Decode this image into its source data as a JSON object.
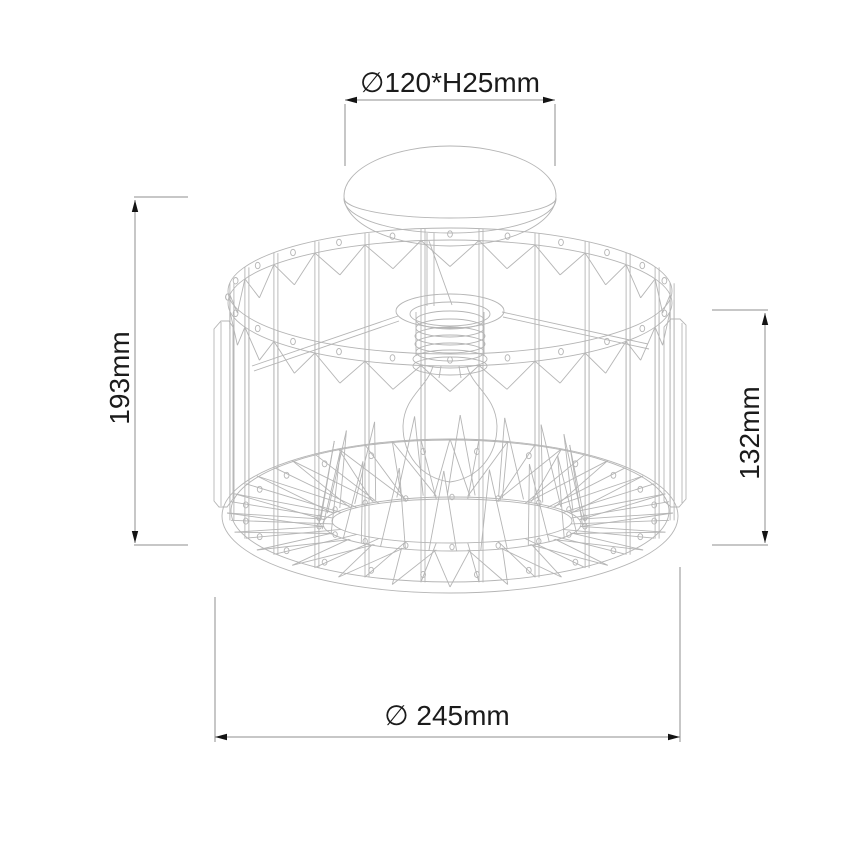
{
  "drawing": {
    "type": "technical-dimension-drawing",
    "subject": "semi-flush ceiling lamp with wireframe crystal drum shade, canopy and E27 bulb",
    "dimensions": {
      "canopy": {
        "label": "∅120*H25mm",
        "diameter_mm": 120,
        "height_mm": 25,
        "position": "top"
      },
      "total_height": {
        "label": "193mm",
        "value_mm": 193,
        "position": "left"
      },
      "shade_height": {
        "label": "132mm",
        "value_mm": 132,
        "position": "right"
      },
      "shade_diameter": {
        "label": "∅ 245mm",
        "value_mm": 245,
        "position": "bottom"
      }
    },
    "colors": {
      "background": "#ffffff",
      "sketch_line": "#b5b5b5",
      "dim_line": "#8f8f8f",
      "arrow": "#141414",
      "text": "#1b1b1b"
    }
  }
}
